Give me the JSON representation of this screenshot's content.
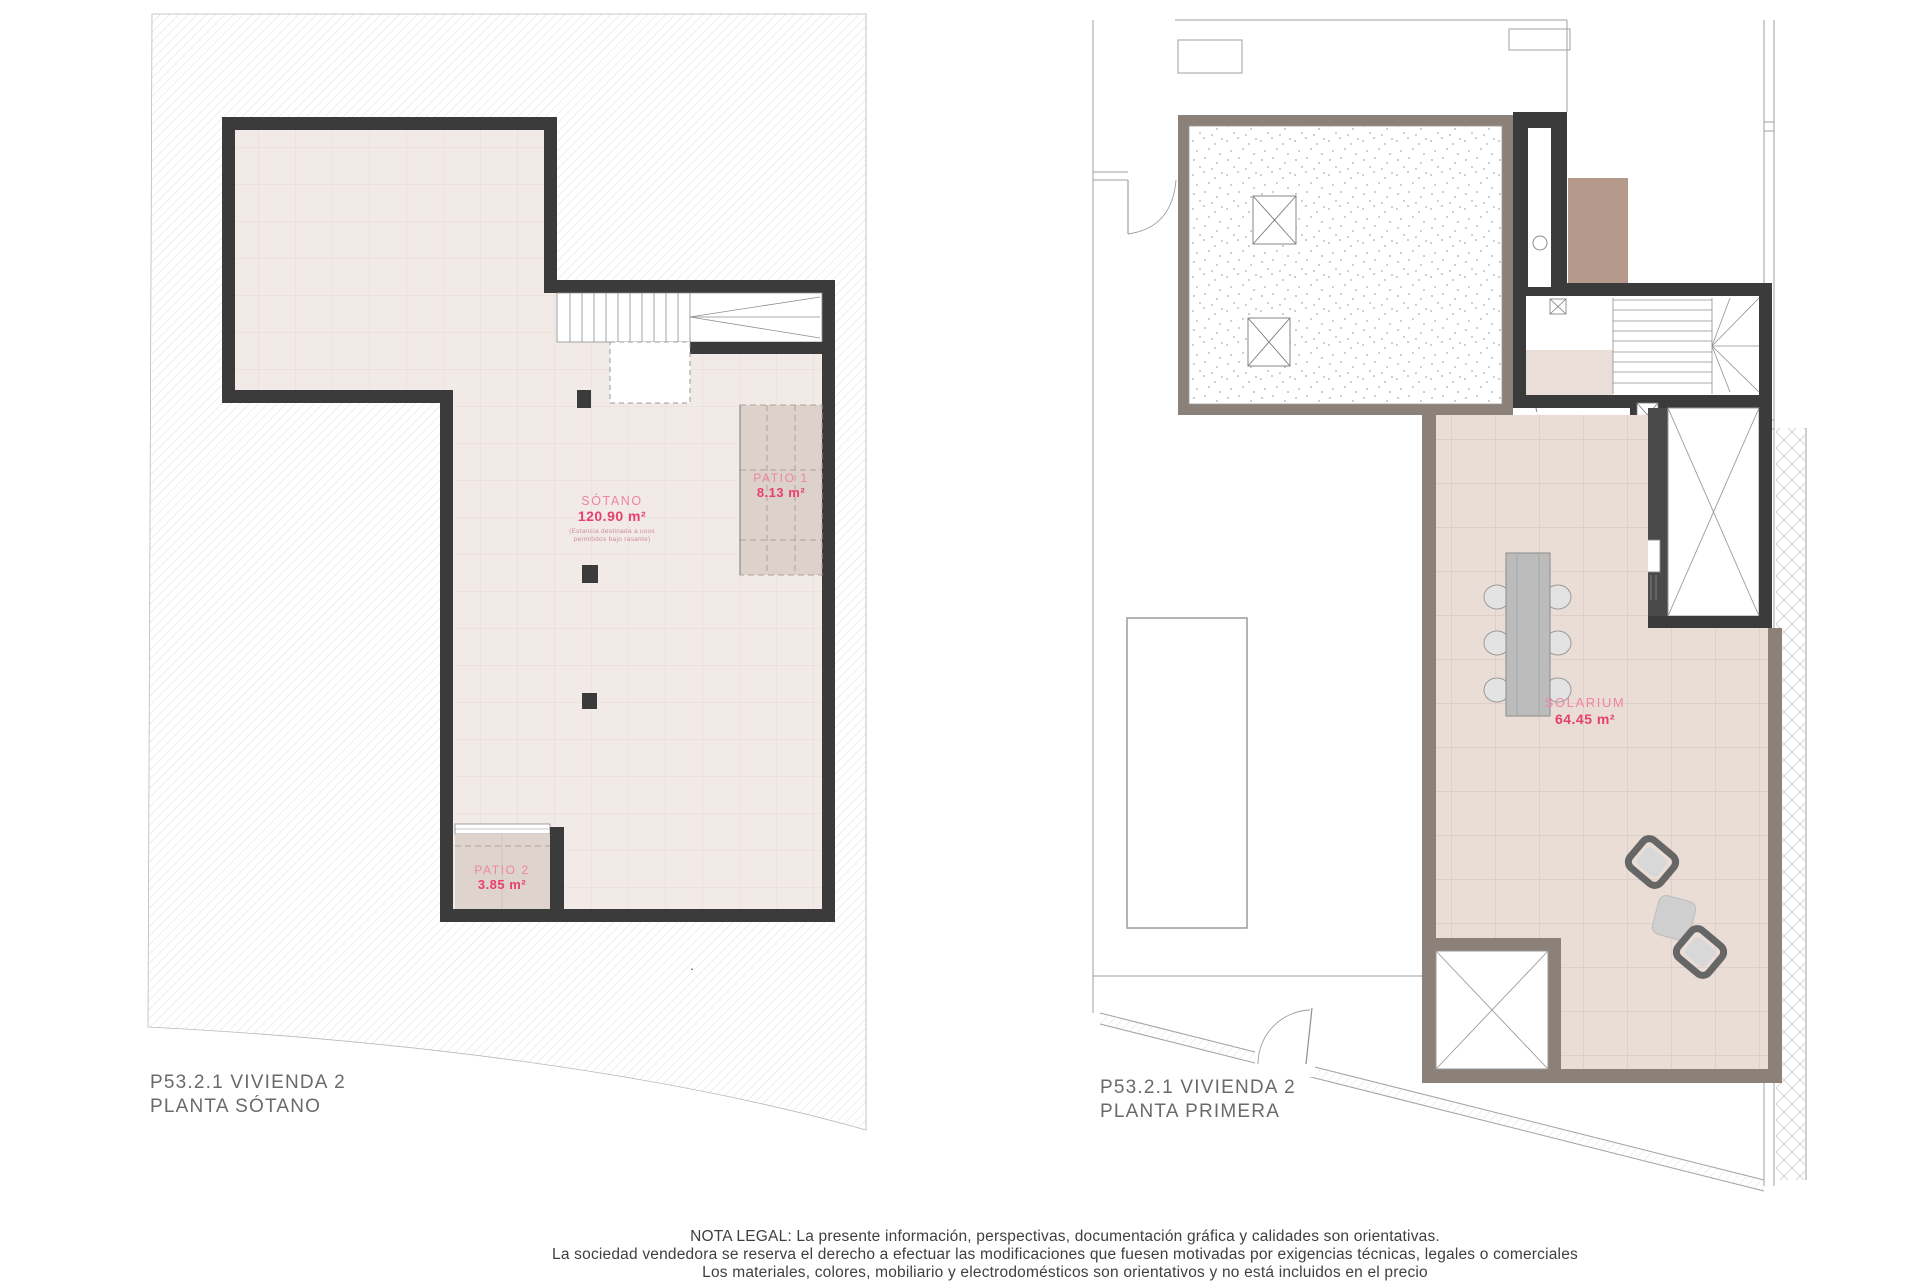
{
  "sheet": {
    "left_plan": {
      "title_line1": "P53.2.1 VIVIENDA 2",
      "title_line2": "PLANTA SÓTANO",
      "rooms": {
        "sotano": {
          "name": "SÓTANO",
          "area": "120.90 m²",
          "note1": "(Estancia destinada a usos",
          "note2": "permitidos bajo rasante)"
        },
        "patio1": {
          "name": "PATIO 1",
          "area": "8.13 m²"
        },
        "patio2": {
          "name": "PATIO 2",
          "area": "3.85 m²"
        }
      }
    },
    "right_plan": {
      "title_line1": "P53.2.1 VIVIENDA 2",
      "title_line2": "PLANTA PRIMERA",
      "rooms": {
        "solarium": {
          "name": "SOLARIUM",
          "area": "64.45 m²"
        }
      }
    },
    "separator_dot": ".",
    "legal": {
      "line1": "NOTA LEGAL: La presente información, perspectivas, documentación gráfica y calidades son orientativas.",
      "line2": "La sociedad vendedora se reserva el derecho a efectuar las modificaciones que fuesen motivadas por exigencias técnicas, legales o comerciales",
      "line3": "Los materiales, colores, mobiliario y electrodomésticos son orientativos y no está incluidos en el precio"
    },
    "colors": {
      "wall_dark": "#3b3b3b",
      "wall_taupe": "#8b8178",
      "floor_basement": "#f1eae6",
      "floor_solarium": "#e9ddd6",
      "label_pink": "#ee85a2",
      "label_pink_strong": "#e7406d",
      "title_gray": "#6a6a6a",
      "brown_block": "#b59a8b"
    }
  }
}
